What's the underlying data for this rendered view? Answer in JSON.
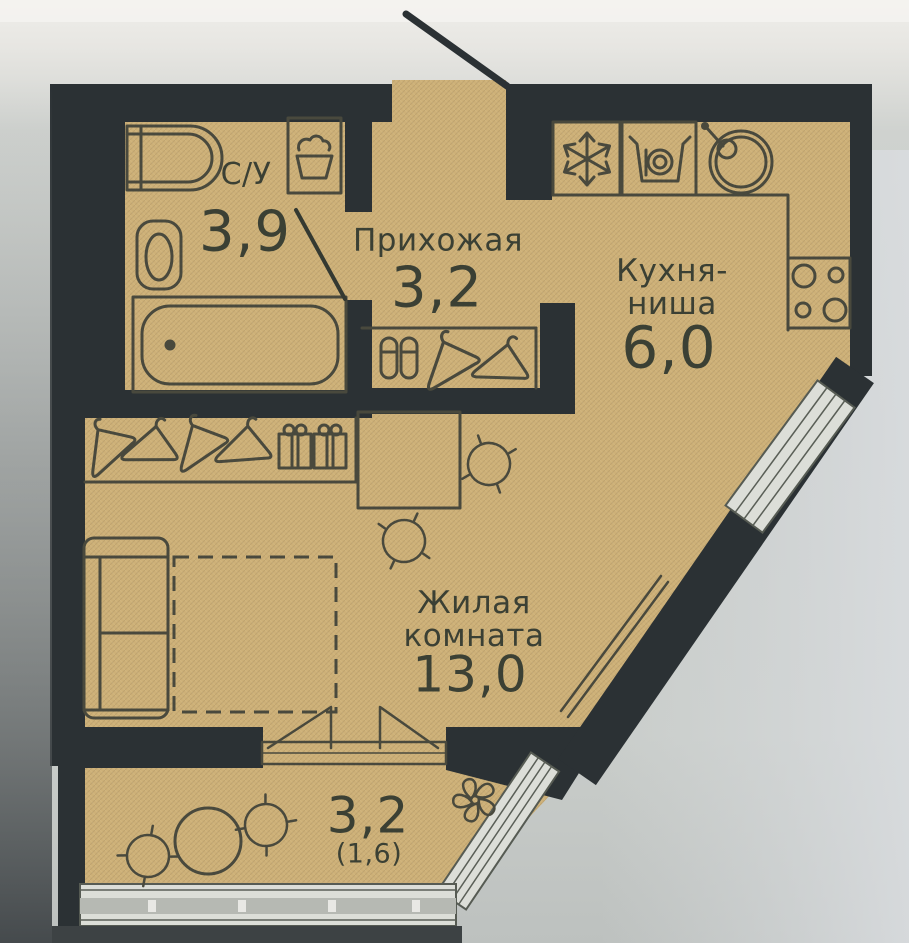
{
  "rooms": {
    "bathroom": {
      "name": "С/У",
      "area": "3,9"
    },
    "hallway": {
      "name": "Прихожая",
      "area": "3,2"
    },
    "kitchen": {
      "name": "Кухня-\nниша",
      "area": "6,0"
    },
    "living": {
      "name": "Жилая\nкомната",
      "area": "13,0"
    },
    "balcony": {
      "area": "3,2",
      "area_reduced": "(1,6)"
    }
  },
  "colors": {
    "floor": "#cdb077",
    "wall": "#2b3134",
    "line": "#49493d",
    "glaze": "#dcded8",
    "text": "#3b4034",
    "background": "#c9cdca"
  },
  "icons": [
    "washbasin-icon",
    "laundry-sink-icon",
    "toilet-icon",
    "bathtub-icon",
    "door-leaf-icon",
    "fridge-snowflake-icon",
    "washing-machine-icon",
    "kitchen-sink-icon",
    "stove-icon",
    "hanger-icon",
    "gift-box-icon",
    "shoes-icon",
    "desk-icon",
    "chair-icon",
    "sofa-icon",
    "bed-outline-icon",
    "radiator-icon",
    "casement-window-icon",
    "balcony-table-icon",
    "plant-icon"
  ]
}
